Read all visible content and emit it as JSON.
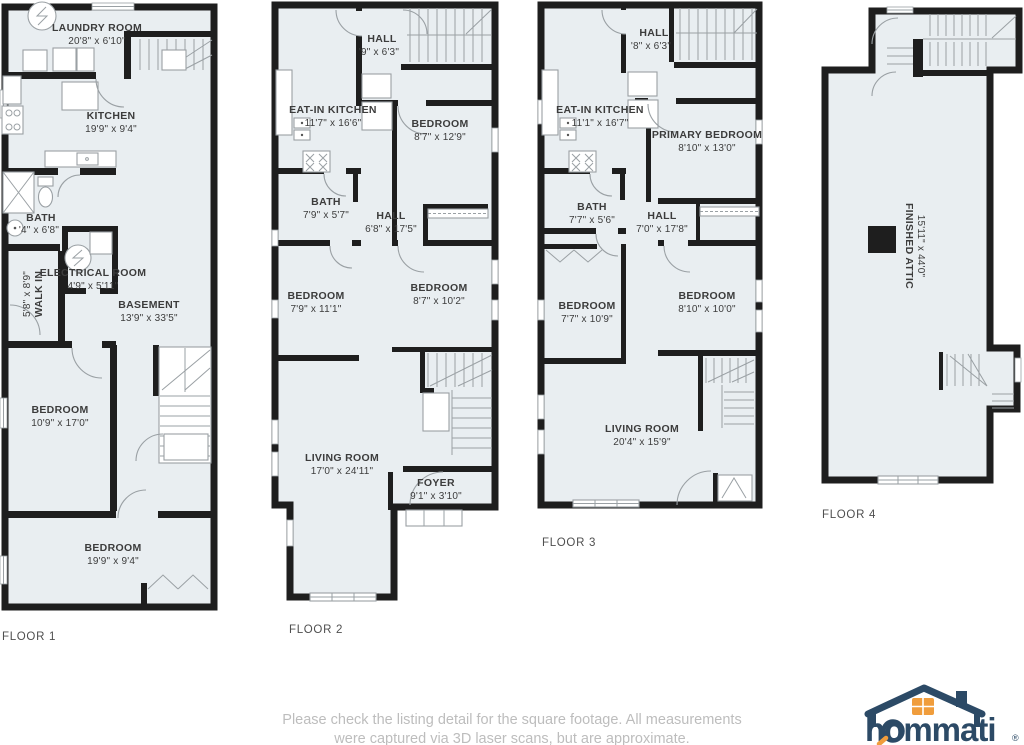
{
  "colors": {
    "wall": "#1e1e1e",
    "floor": "#e9eef1",
    "line": "#9aa0a4",
    "text": "#3c3c3c",
    "caption": "#4f4f4f",
    "muted": "#bdbdbd",
    "navy": "#2c4a66",
    "orange": "#f09d3c",
    "bg": "#ffffff"
  },
  "floors": [
    {
      "caption": "FLOOR 1",
      "rooms": [
        {
          "name": "LAUNDRY ROOM",
          "dims": "20'8\" x 6'10\""
        },
        {
          "name": "KITCHEN",
          "dims": "19'9\" x 9'4\""
        },
        {
          "name": "BATH",
          "dims": "'4\" x 6'8\""
        },
        {
          "name": "WALK IN",
          "dims": "5'8\" x 8'9\""
        },
        {
          "name": "ELECTRICAL ROOM",
          "dims": "4'9\" x 5'11\""
        },
        {
          "name": "BASEMENT",
          "dims": "13'9\" x 33'5\""
        },
        {
          "name": "BEDROOM",
          "dims": "10'9\" x 17'0\""
        },
        {
          "name": "BEDROOM",
          "dims": "19'9\" x 9'4\""
        }
      ]
    },
    {
      "caption": "FLOOR 2",
      "rooms": [
        {
          "name": "HALL",
          "dims": "'9\" x 6'3\""
        },
        {
          "name": "EAT-IN KITCHEN",
          "dims": "11'7\" x 16'6\""
        },
        {
          "name": "BEDROOM",
          "dims": "8'7\" x 12'9\""
        },
        {
          "name": "BATH",
          "dims": "7'9\" x 5'7\""
        },
        {
          "name": "HALL",
          "dims": "6'8\" x 17'5\""
        },
        {
          "name": "BEDROOM",
          "dims": "7'9\" x 11'1\""
        },
        {
          "name": "BEDROOM",
          "dims": "8'7\" x 10'2\""
        },
        {
          "name": "LIVING ROOM",
          "dims": "17'0\" x 24'11\""
        },
        {
          "name": "FOYER",
          "dims": "9'1\" x 3'10\""
        }
      ]
    },
    {
      "caption": "FLOOR 3",
      "rooms": [
        {
          "name": "HALL",
          "dims": "'8\" x 6'3\""
        },
        {
          "name": "EAT-IN KITCHEN",
          "dims": "11'1\" x 16'7\""
        },
        {
          "name": "PRIMARY BEDROOM",
          "dims": "8'10\" x 13'0\""
        },
        {
          "name": "BATH",
          "dims": "7'7\" x 5'6\""
        },
        {
          "name": "HALL",
          "dims": "7'0\" x 17'8\""
        },
        {
          "name": "BEDROOM",
          "dims": "7'7\" x 10'9\""
        },
        {
          "name": "BEDROOM",
          "dims": "8'10\" x 10'0\""
        },
        {
          "name": "LIVING ROOM",
          "dims": "20'4\" x 15'9\""
        }
      ]
    },
    {
      "caption": "FLOOR 4",
      "rooms": [
        {
          "name": "FINISHED ATTIC",
          "dims": "15'11\" x 44'0\""
        }
      ]
    }
  ],
  "disclaimer": {
    "line1": "Please check the listing detail for the square footage. All measurements",
    "line2": "were captured via 3D laser scans, but are approximate."
  },
  "logo": {
    "text": "hommati",
    "reg": "®"
  }
}
